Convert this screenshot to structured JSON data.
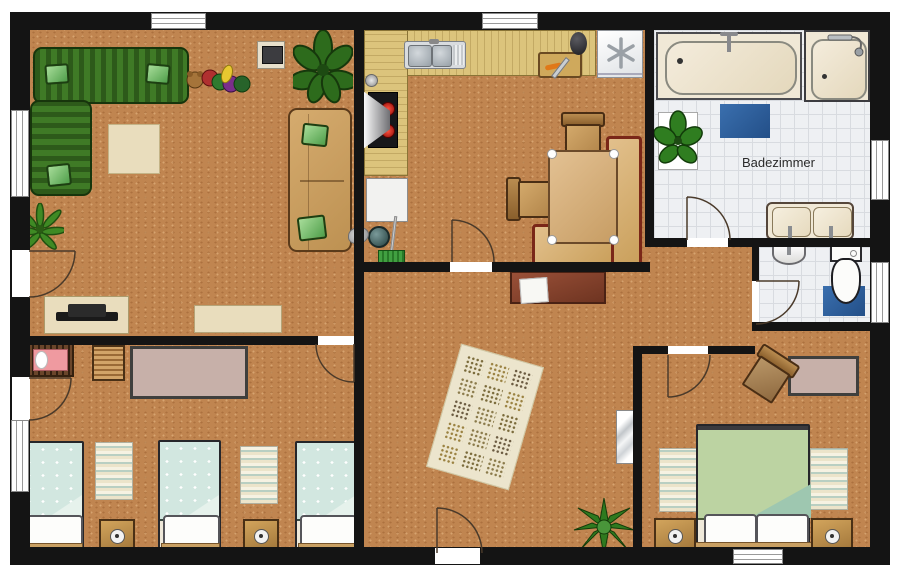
{
  "document": {
    "type": "apartment-floor-plan",
    "canvas_w": 900,
    "canvas_h": 580
  },
  "labels": {
    "bathroom": "Badezimmer"
  },
  "palette": {
    "floor_terracotta": "#c08550",
    "wall_black": "#141414",
    "tile_white": "#eef0f3",
    "tile_grid": "#d8dbe0",
    "counter_wood": "#dcc47c",
    "sofa_green_dark": "#2d5a1a",
    "sofa_green": "#3f7a26",
    "pillow_green": "#7ec97a",
    "furniture_tan": "#cda267",
    "bench_frame_red": "#7a2718",
    "bed_teal": "#d2e7e0",
    "duvet_green": "#bcd3a2",
    "mat_blue": "#2e5f9e",
    "rug_cream": "#ece5cd",
    "rug_mauve": "#c7b0a9",
    "sideboard_brown": "#8a4531",
    "fixture_cream": "#f0e8d6"
  },
  "rooms": [
    {
      "id": "living-room",
      "furniture": [
        "corner-sofa-green",
        "throw-pillow",
        "throw-pillow",
        "throw-pillow",
        "coffee-rug",
        "toy-bear",
        "toy-caterpillar",
        "wall-tv",
        "potted-plant-large",
        "sofa-tan",
        "palm-plant",
        "tv-lowboard",
        "wall-shelf"
      ]
    },
    {
      "id": "kitchen-dining",
      "furniture": [
        "l-shaped-counter",
        "double-sink",
        "faucet",
        "cutting-board",
        "pepper-mill",
        "freezer",
        "stove-with-hood",
        "work-desk",
        "waste-bin",
        "broom",
        "feather-duster",
        "dining-table",
        "corner-bench",
        "dining-chair",
        "dining-chair"
      ]
    },
    {
      "id": "bathroom",
      "label": "Badezimmer",
      "furniture": [
        "bathtub",
        "shower-stall",
        "bath-mat-blue",
        "plant-stand",
        "double-washbasin"
      ]
    },
    {
      "id": "wc",
      "furniture": [
        "hand-basin",
        "toilet",
        "toilet-mat-blue"
      ]
    },
    {
      "id": "hallway",
      "furniture": [
        "sideboard",
        "paper-sheet",
        "patterned-rug",
        "wall-mirror",
        "agave-plant"
      ]
    },
    {
      "id": "kids-bedroom",
      "furniture": [
        "crib",
        "slatted-dresser",
        "mauve-rug",
        "single-bed",
        "single-bed",
        "single-bed",
        "bedside-rug",
        "bedside-rug",
        "nightstand",
        "nightstand"
      ]
    },
    {
      "id": "master-bedroom",
      "furniture": [
        "wooden-chair",
        "mauve-rug",
        "double-bed",
        "bedside-rug",
        "bedside-rug",
        "nightstand",
        "nightstand"
      ]
    }
  ],
  "openings": {
    "windows": 7,
    "interior_doors": 7,
    "entrance_doors": 2
  }
}
